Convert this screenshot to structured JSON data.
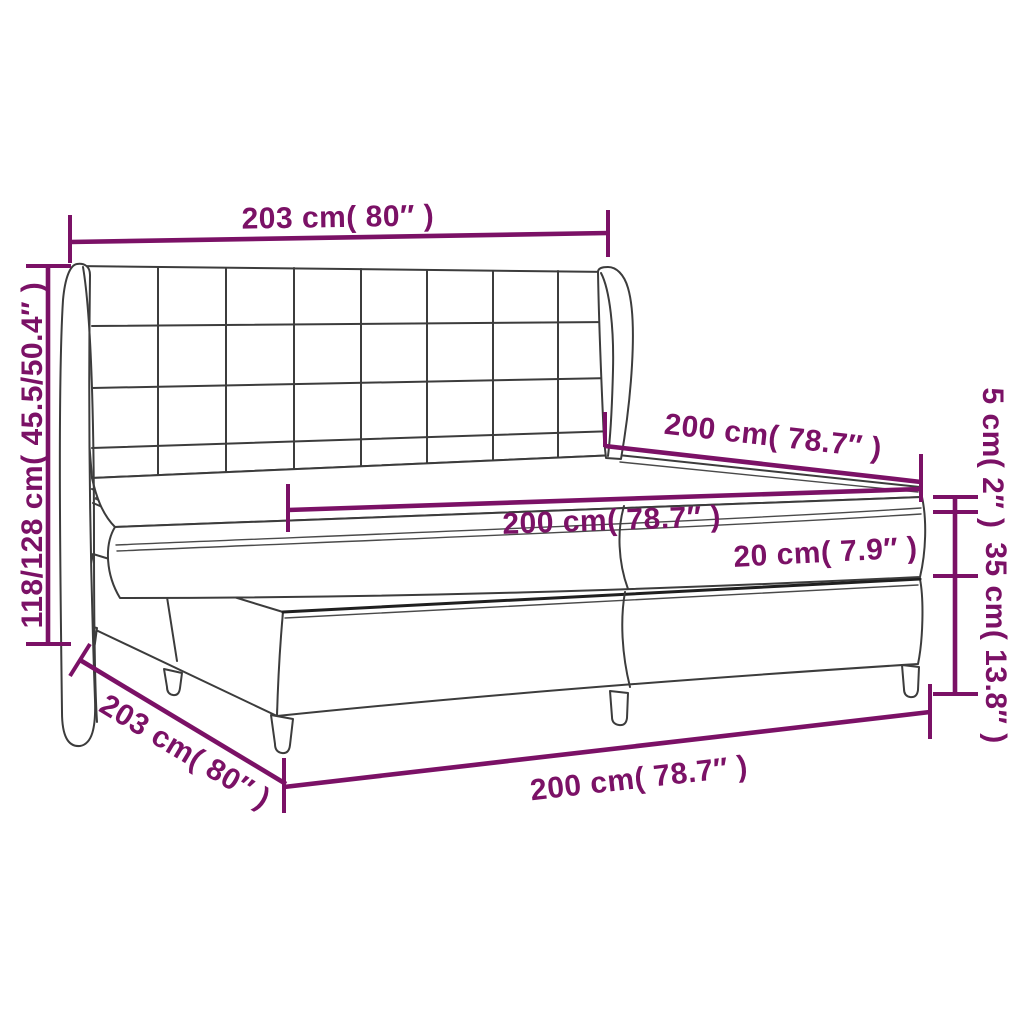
{
  "page": {
    "background": "#ffffff"
  },
  "palette": {
    "dimension_color": "#7B1166",
    "outline_color": "#3C3C3C",
    "dark_edge_color": "#1F1F1F"
  },
  "diagram": {
    "subject": "box-spring-bed-with-wing-headboard",
    "dimensions": {
      "headboard_width": {
        "label": "203 cm( 80″ )"
      },
      "total_height": {
        "label": "118/128 cm( 45.5/50.4″ )"
      },
      "bed_length": {
        "label": "200 cm( 78.7″ )"
      },
      "mattress_width": {
        "label": "200 cm( 78.7″ )"
      },
      "mattress_height": {
        "label": "20 cm( 7.9″ )"
      },
      "topper_height": {
        "label": "5 cm( 2″ )"
      },
      "base_height": {
        "label": "35 cm( 13.8″ )"
      },
      "frame_width": {
        "label": "203 cm( 80″ )"
      },
      "base_width": {
        "label": "200 cm( 78.7″ )"
      }
    }
  }
}
